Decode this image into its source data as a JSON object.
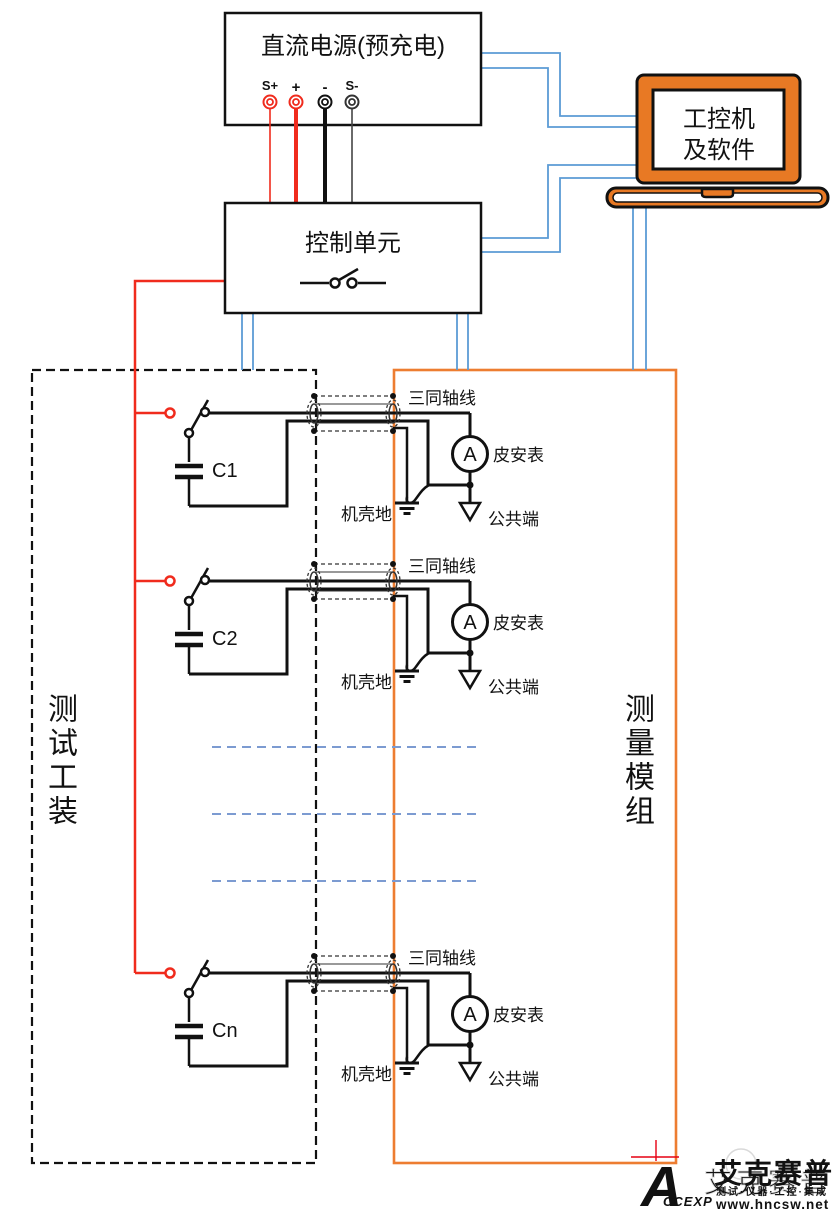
{
  "diagram": {
    "power_supply": {
      "title": "直流电源(预充电)",
      "terminals": [
        "S+",
        "+",
        "-",
        "S-"
      ]
    },
    "control_unit": {
      "title": "控制单元"
    },
    "ipc": {
      "line1": "工控机",
      "line2": "及软件"
    },
    "test_fixture": {
      "label": "测试工装"
    },
    "measurement_module": {
      "label": "测量模组"
    },
    "rows": [
      {
        "capacitor": "C1"
      },
      {
        "capacitor": "C2"
      },
      {
        "capacitor": "Cn"
      }
    ],
    "row_labels": {
      "triax": "三同轴线",
      "ammeter_symbol": "A",
      "ammeter": "皮安表",
      "chassis_ground": "机壳地",
      "common": "公共端"
    }
  },
  "logo": {
    "mark": "A",
    "mark_text": "CCEXP",
    "brand": "艾克赛普",
    "watermark": "艾克赛普",
    "tagline": "测试·仪器·工控·集成",
    "url": "www.hncsw.net"
  },
  "colors": {
    "orange": "#ED7D31",
    "blue": "#5B9BD5",
    "dashed_blue": "#7C9BD1",
    "red": "#F02B1D",
    "black": "#111111",
    "logo_red": "#E60012"
  }
}
